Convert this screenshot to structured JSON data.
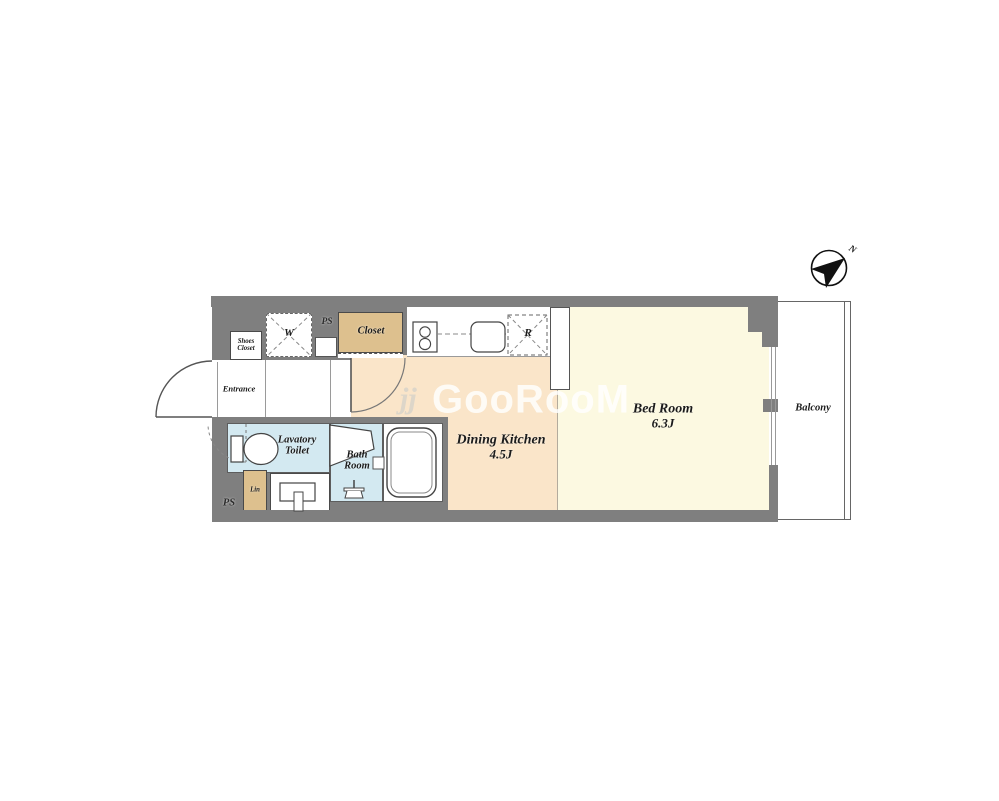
{
  "plan": {
    "entrance": "Entrance",
    "shoes_closet_line1": "Shoes",
    "shoes_closet_line2": "Closet",
    "washer": "W",
    "ps_top": "PS",
    "closet": "Closet",
    "fridge": "R",
    "dining_kitchen_name": "Dining Kitchen",
    "dining_kitchen_size": "4.5J",
    "bed_room_name": "Bed Room",
    "bed_room_size": "6.3J",
    "lavatory_line1": "Lavatory",
    "lavatory_line2": "Toilet",
    "bath_line1": "Bath",
    "bath_line2": "Room",
    "linen": "Lin",
    "ps_bottom": "PS",
    "balcony": "Balcony"
  },
  "compass": {
    "north": "N"
  },
  "watermark": {
    "icon": "jj",
    "text": "GooRooM"
  },
  "colors": {
    "wall": "#7f7f7f",
    "dining_kitchen_floor": "#fae5c9",
    "bedroom_floor": "#fcf9e1",
    "wet_area_floor": "#d3e9f1",
    "storage_fill": "#ddc08e"
  }
}
